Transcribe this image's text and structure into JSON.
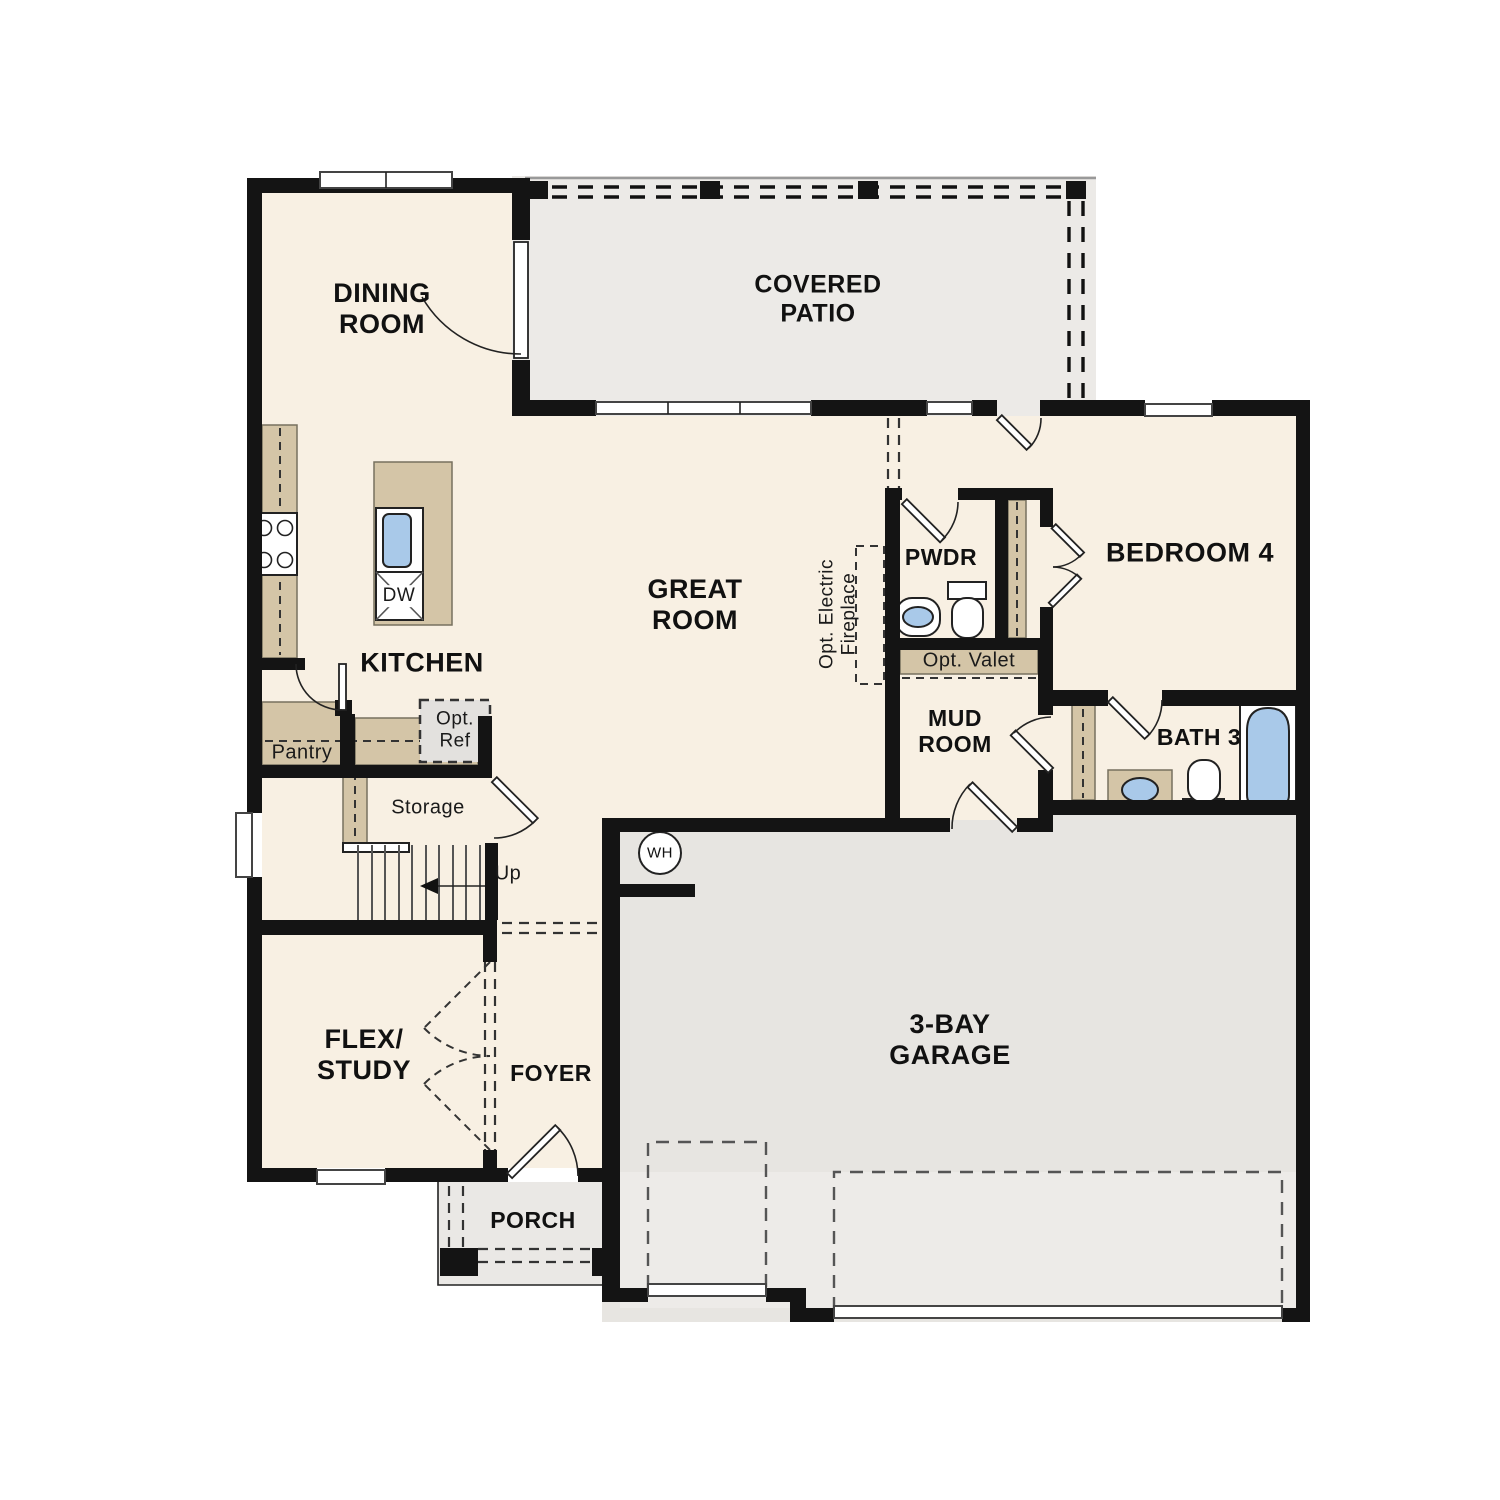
{
  "palette": {
    "wall": "#141414",
    "floor": "#f8f0e3",
    "patio": "#eceae7",
    "garage": "#e7e5e1",
    "garage_front": "#edebe8",
    "porch": "#eae8e5",
    "counter": "#d4c5a7",
    "fixture_blue": "#a9c9e9"
  },
  "labels": {
    "dining_room": "DINING\nROOM",
    "covered_patio": "COVERED\nPATIO",
    "great_room": "GREAT\nROOM",
    "kitchen": "KITCHEN",
    "bedroom_4": "BEDROOM 4",
    "powder": "PWDR",
    "bath_3": "BATH 3",
    "mud_room": "MUD\nROOM",
    "flex_study": "FLEX/\nSTUDY",
    "foyer": "FOYER",
    "porch": "PORCH",
    "garage": "3-BAY\nGARAGE",
    "pantry": "Pantry",
    "storage": "Storage",
    "opt_ref": "Opt.\nRef",
    "opt_valet": "Opt. Valet",
    "opt_electric_fireplace": "Opt. Electric\nFireplace",
    "up": "Up",
    "dishwasher": "DW",
    "water_heater": "WH"
  }
}
